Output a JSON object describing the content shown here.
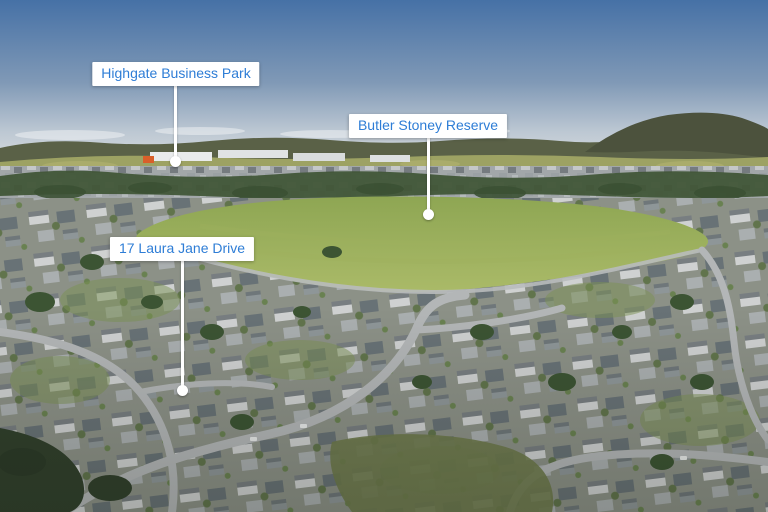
{
  "image": {
    "description": "Aerial drone photograph of a suburban neighbourhood with a large grass reserve, a business park and bush-covered hills in the distance under a blue sky",
    "accent_color": "#2e7dd6",
    "label_background": "#ffffff",
    "marker_color": "#ffffff"
  },
  "callouts": [
    {
      "label": "Highgate Business Park"
    },
    {
      "label": "Butler Stoney Reserve"
    },
    {
      "label": "17 Laura Jane Drive"
    }
  ]
}
